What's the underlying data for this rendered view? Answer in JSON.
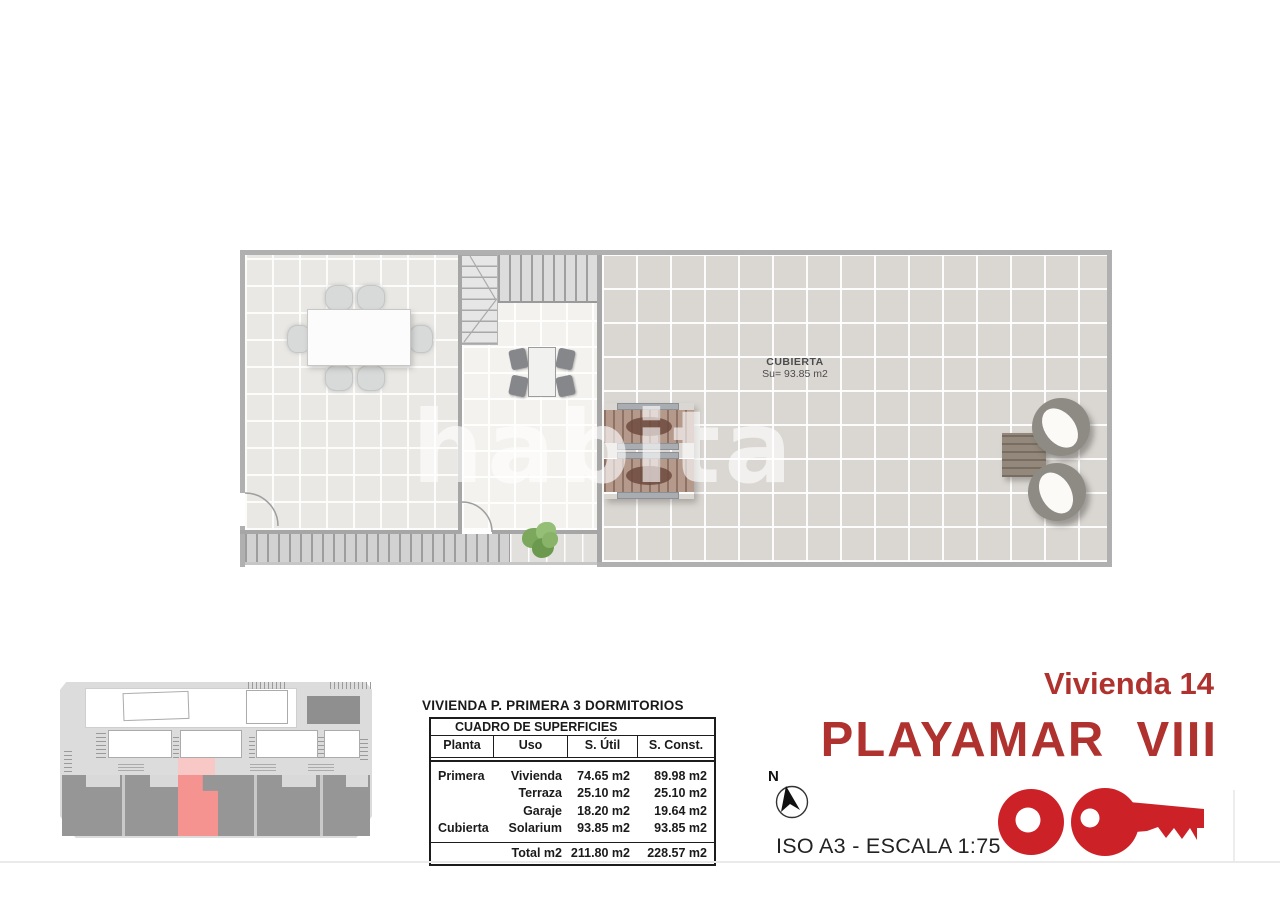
{
  "floor_plan": {
    "room_label": "CUBIERTA",
    "room_area": "Su= 93.85 m2",
    "watermark": "habita"
  },
  "surfaces_table": {
    "title": "VIVIENDA P. PRIMERA 3 DORMITORIOS",
    "header": "CUADRO DE SUPERFICIES",
    "columns": [
      "Planta",
      "Uso",
      "S. Útil",
      "S. Const."
    ],
    "rows": [
      [
        "Primera",
        "Vivienda",
        "74.65 m2",
        "89.98 m2"
      ],
      [
        "",
        "Terraza",
        "25.10 m2",
        "25.10 m2"
      ],
      [
        "",
        "Garaje",
        "18.20 m2",
        "19.64 m2"
      ],
      [
        "Cubierta",
        "Solarium",
        "93.85 m2",
        "93.85 m2"
      ]
    ],
    "total_label": "Total m2",
    "total_util": "211.80 m2",
    "total_const": "228.57 m2"
  },
  "title_block": {
    "unit_label": "Vivienda 14",
    "project_name": "PLAYAMAR  VIII",
    "compass_letter": "N",
    "format_scale": "ISO A3 - ESCALA 1:75"
  },
  "branding": {
    "logo_icon": "key-logo-icon",
    "accent_red": "#b0322f",
    "logo_red": "#cb2127",
    "highlight_pink": "#f49390"
  }
}
